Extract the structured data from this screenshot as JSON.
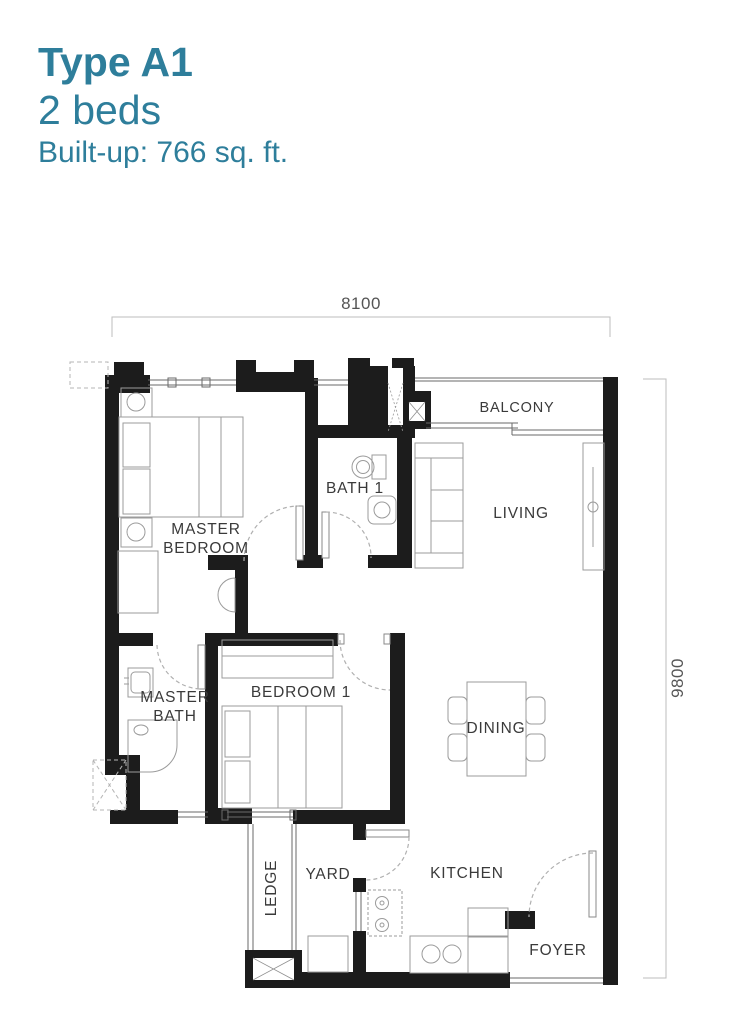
{
  "header": {
    "plan_type": "Type A1",
    "beds": "2 beds",
    "built_up": "Built-up: 766 sq. ft."
  },
  "dimensions": {
    "width_mm": "8100",
    "height_mm": "9800"
  },
  "rooms": {
    "master_bedroom": {
      "line1": "MASTER",
      "line2": "BEDROOM"
    },
    "bath1": {
      "label": "BATH 1"
    },
    "balcony": {
      "label": "BALCONY"
    },
    "living": {
      "label": "LIVING"
    },
    "master_bath": {
      "line1": "MASTER",
      "line2": "BATH"
    },
    "bedroom1": {
      "label": "BEDROOM 1"
    },
    "dining": {
      "label": "DINING"
    },
    "ledge": {
      "label": "LEDGE"
    },
    "yard": {
      "label": "YARD"
    },
    "kitchen": {
      "label": "KITCHEN"
    },
    "foyer": {
      "label": "FOYER"
    }
  },
  "colors": {
    "accent": "#2e7e9b",
    "wall": "#1c1c1c",
    "label": "#3a3a3a",
    "furniture": "#9b9b9b",
    "window": "#6a6a6a",
    "door_dash": "#b0b0b0",
    "dim_line": "#bdbdbd",
    "dim_text": "#555555"
  }
}
